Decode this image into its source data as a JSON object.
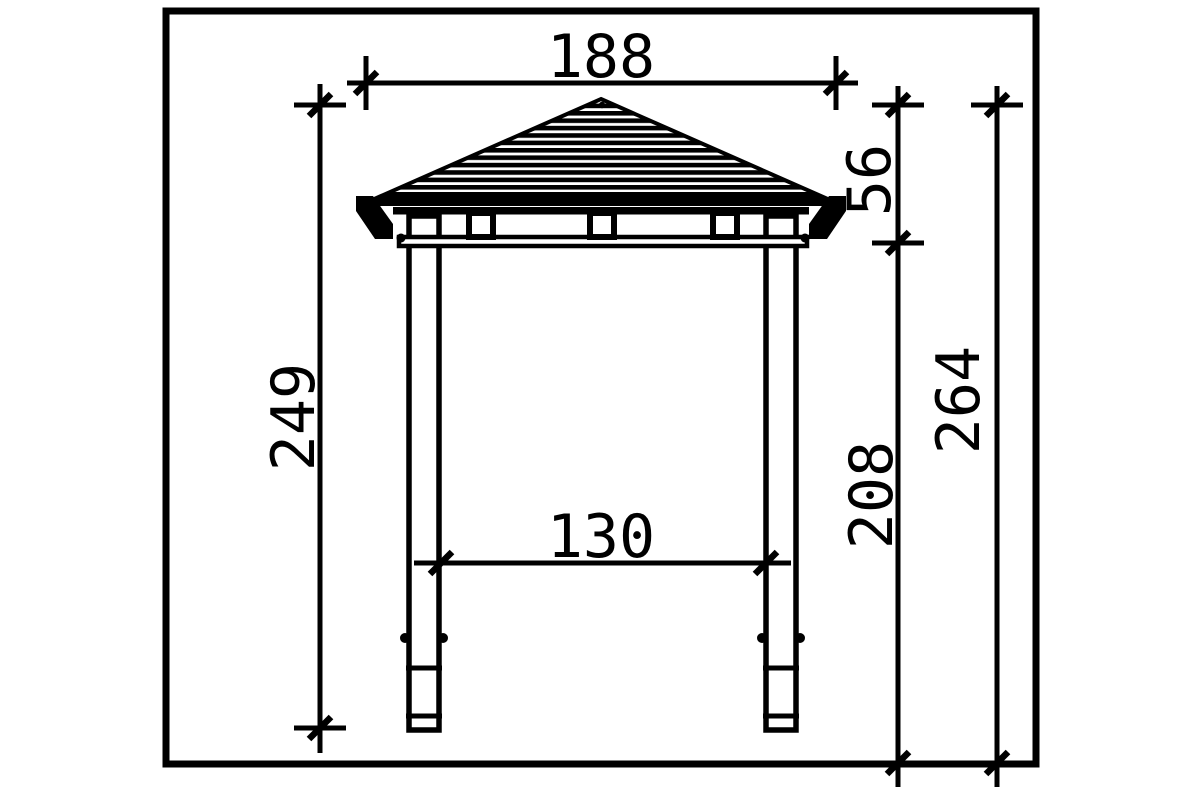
{
  "drawing": {
    "subject": "gazebo-side-elevation-technical-drawing",
    "line_color": "#000000",
    "background_color": "#ffffff",
    "dimensions": {
      "roof_width": "188",
      "roof_height": "56",
      "structure_height": "249",
      "post_clear_height": "208",
      "total_height": "264",
      "post_spacing": "130"
    }
  }
}
